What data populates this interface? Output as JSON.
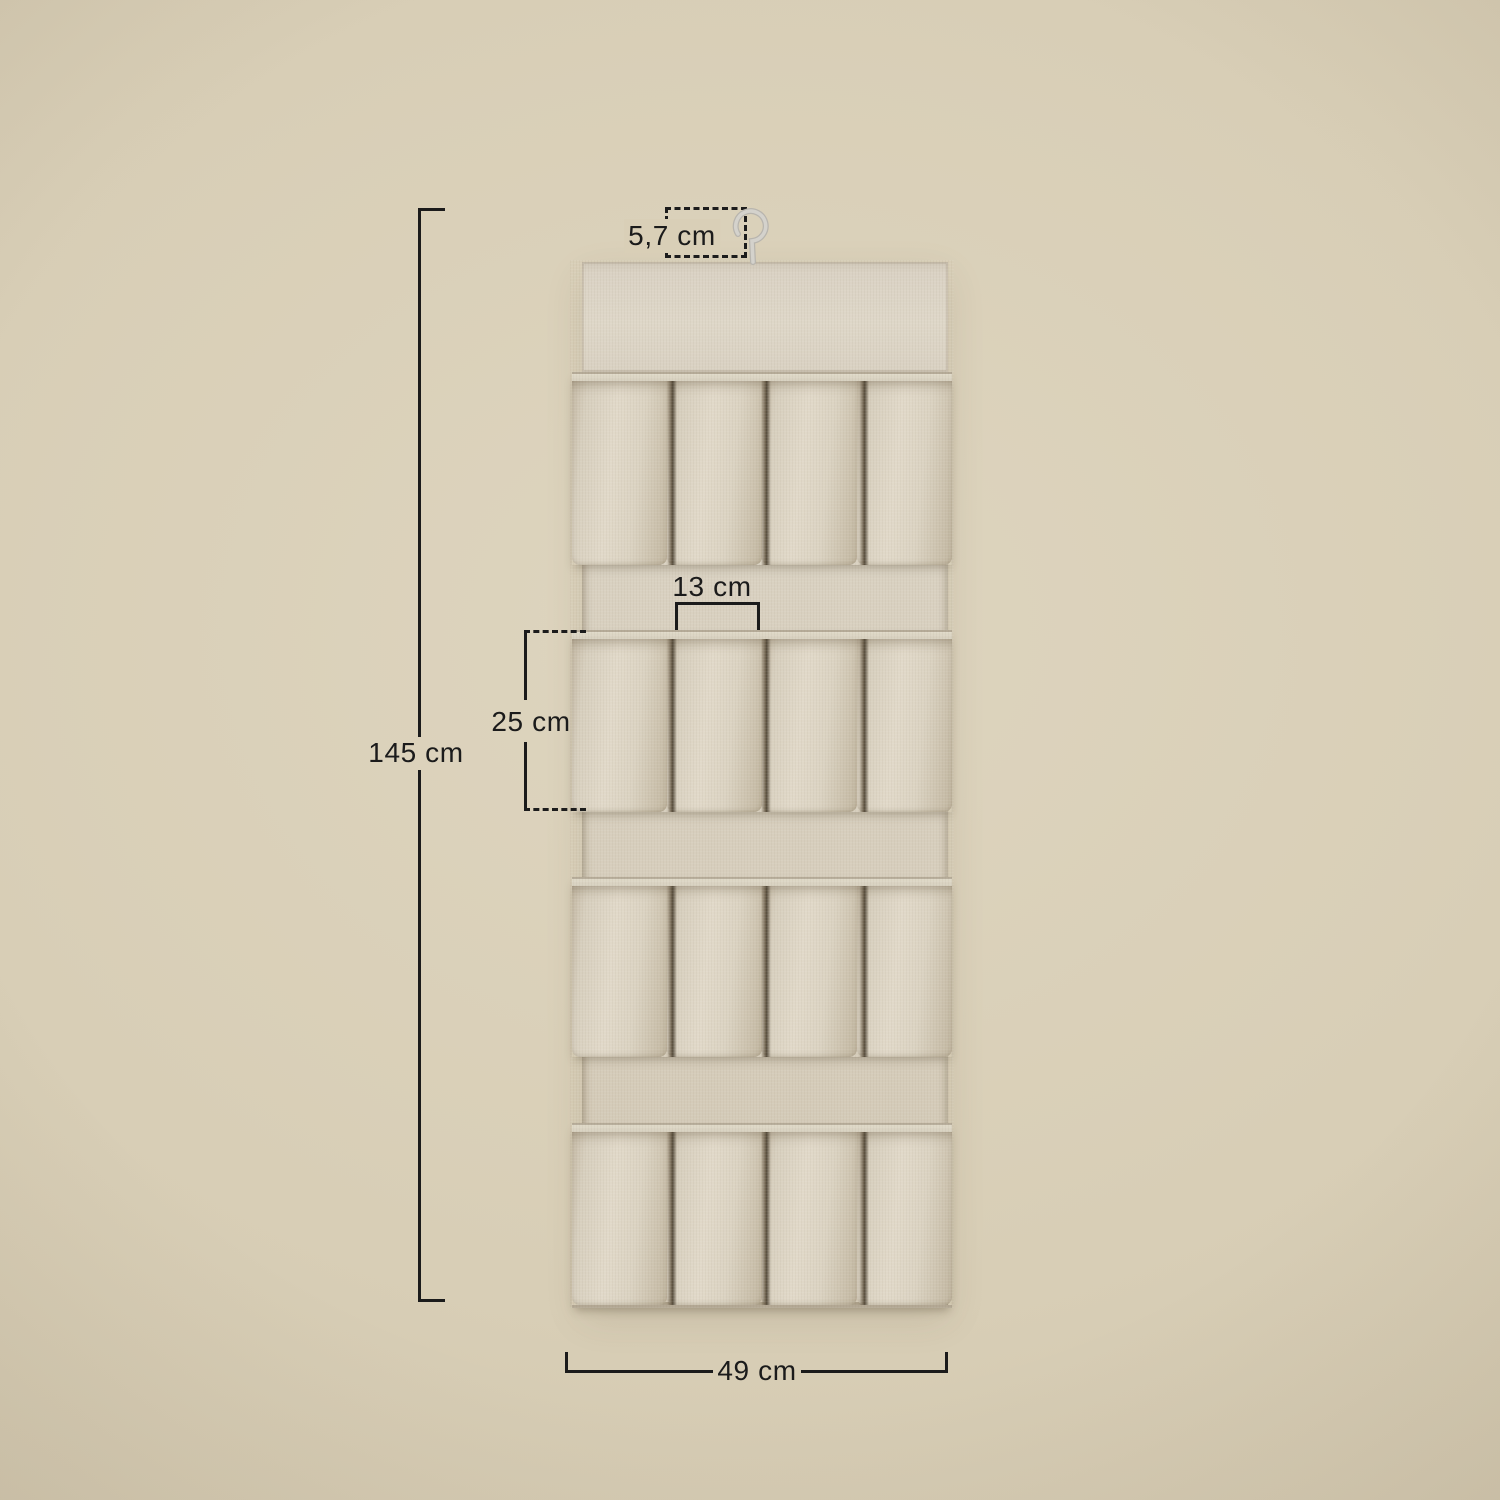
{
  "scene": {
    "type": "product-dimension-diagram",
    "product": "hanging fabric shoe organizer with pockets"
  },
  "labels": {
    "hook_width": "5,7 cm",
    "pocket_width": "13 cm",
    "pocket_height": "25 cm",
    "total_height": "145 cm",
    "total_width": "49 cm"
  },
  "organizer": {
    "rows": 4,
    "pockets_per_row": 4
  },
  "style": {
    "background_color": "#d7ccb3",
    "annotation_color": "#1b1b1b",
    "fabric_color": "#d8cfbe",
    "hook_color": "#c9c6c0"
  }
}
